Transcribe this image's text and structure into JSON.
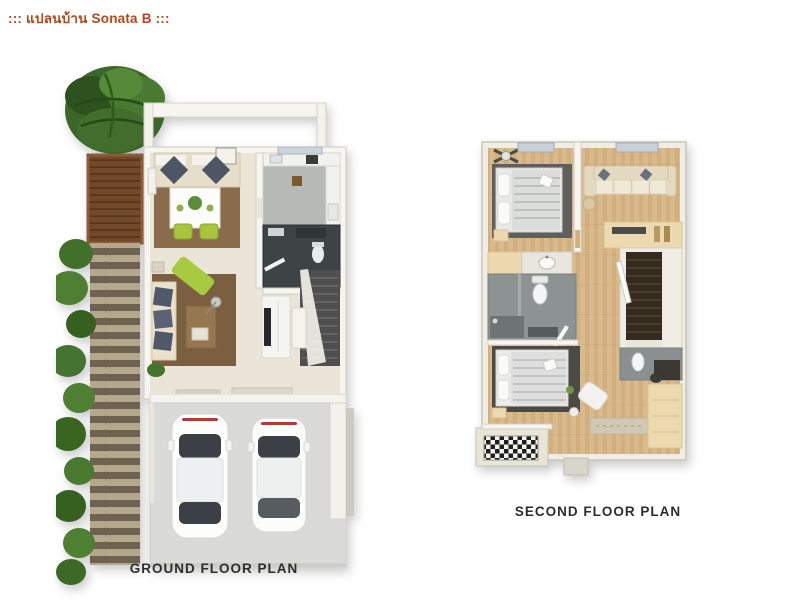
{
  "title": {
    "text": "::: แปลนบ้าน Sonata B :::"
  },
  "colors": {
    "title": "#b2481b",
    "plan_label": "#2d2d2d",
    "background": "#ffffff",
    "accent_green_chair": "#a7c83e",
    "wood_floor": "#d9b98c",
    "deck_brown": "#7a5230",
    "wall_white": "#f5f4ee"
  },
  "plans": {
    "ground": {
      "label": "GROUND FLOOR PLAN",
      "features": [
        "palm-tree",
        "wood-deck",
        "garden-path",
        "dining-area",
        "kitchen",
        "bathroom",
        "living-area",
        "staircase",
        "garage-with-two-cars"
      ]
    },
    "second": {
      "label": "SECOND FLOOR PLAN",
      "features": [
        "bedroom-front",
        "lounge-area",
        "bathroom",
        "staircase",
        "master-bedroom",
        "wardrobe",
        "checkered-balcony"
      ]
    }
  }
}
